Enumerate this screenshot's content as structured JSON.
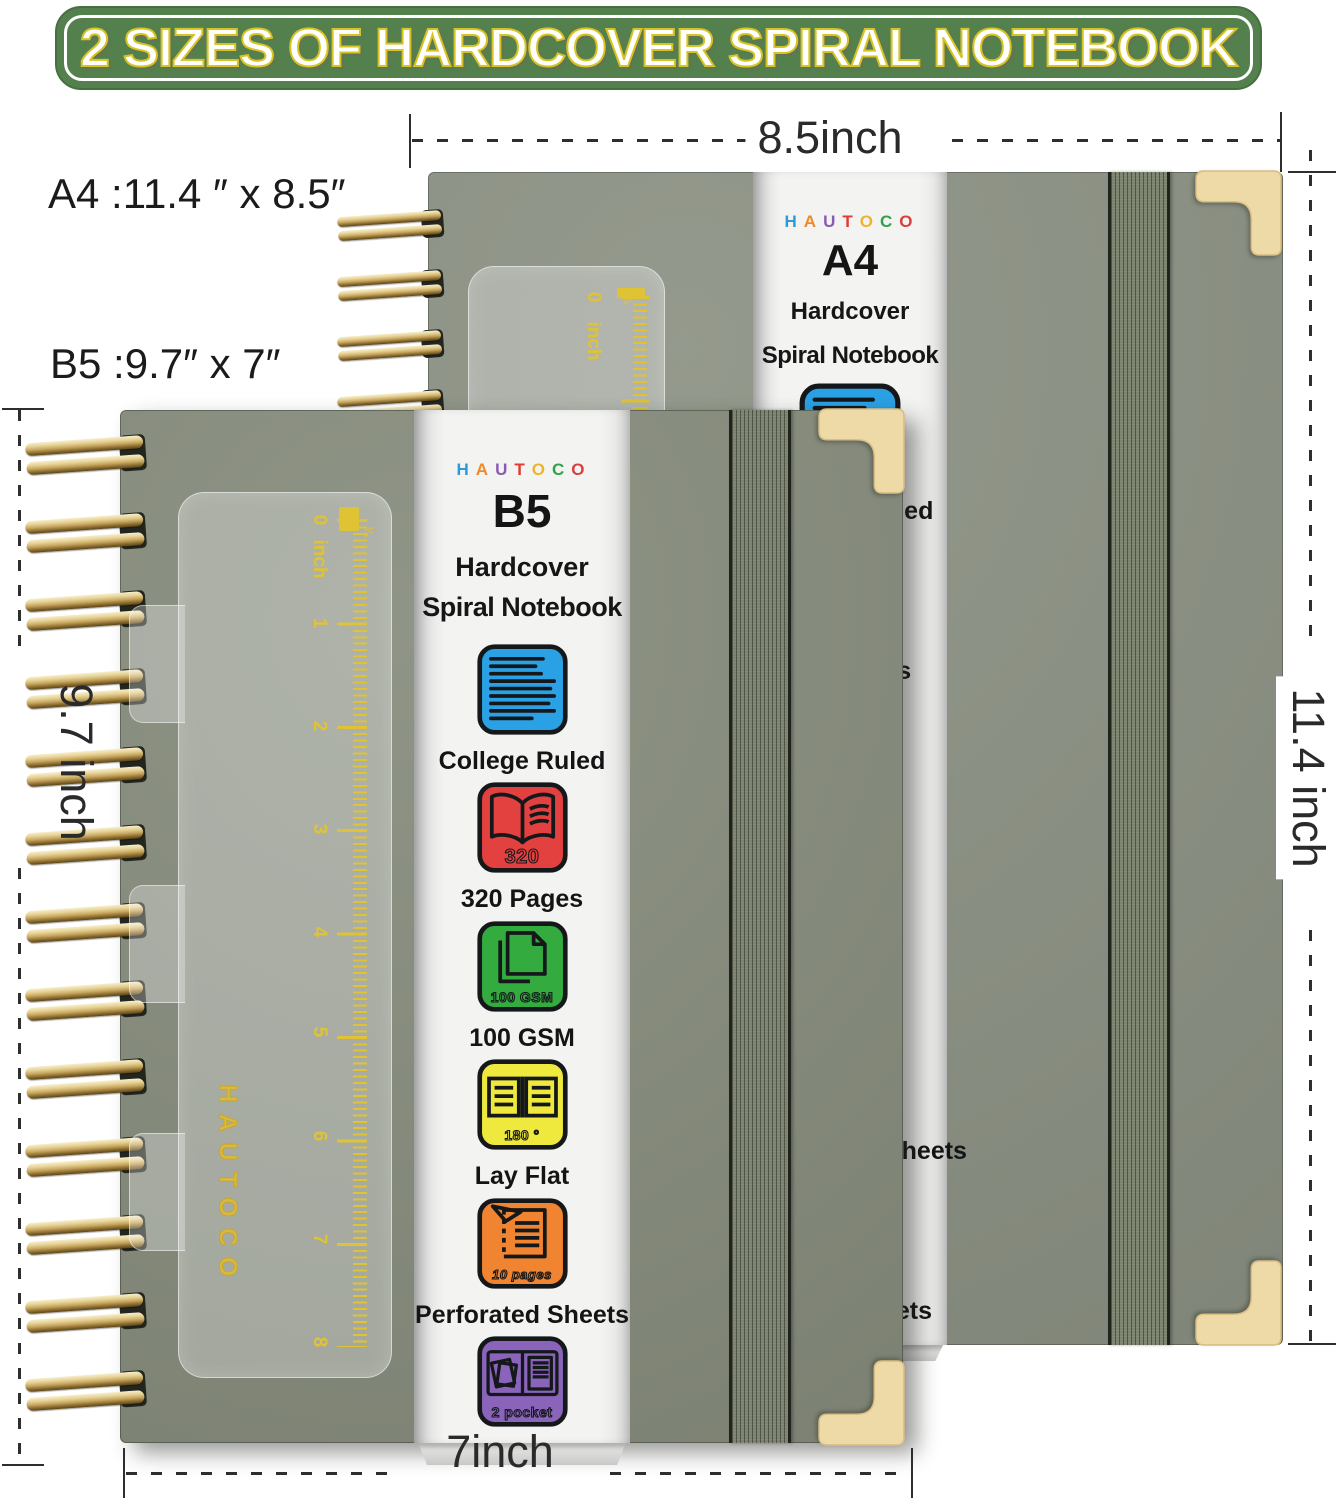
{
  "title": "2 SIZES OF HARDCOVER SPIRAL NOTEBOOK",
  "size_labels": {
    "a4": "A4 :11.4 ″ x 8.5″",
    "b5": "B5 :9.7″ x 7″"
  },
  "dimensions": {
    "top": "8.5inch",
    "right": "11.4 inch",
    "bottom": "7inch",
    "left": "9.7 inch"
  },
  "brand": {
    "name": "HAUTOCO",
    "letters": [
      {
        "ch": "H",
        "color": "#2d9bd6"
      },
      {
        "ch": "A",
        "color": "#f08a28"
      },
      {
        "ch": "U",
        "color": "#8a5ab4"
      },
      {
        "ch": "T",
        "color": "#e23a32"
      },
      {
        "ch": "O",
        "color": "#f0b42c"
      },
      {
        "ch": "C",
        "color": "#2fa24a"
      },
      {
        "ch": "O",
        "color": "#d84040"
      }
    ]
  },
  "notebooks": {
    "a4": {
      "model": "A4",
      "type_line1": "Hardcover",
      "type_line2": "Spiral Notebook"
    },
    "b5": {
      "model": "B5",
      "type_line1": "Hardcover",
      "type_line2": "Spiral Notebook"
    }
  },
  "features": [
    {
      "id": "college-ruled",
      "label": "College Ruled",
      "color": "#2aa1e4",
      "badge": ""
    },
    {
      "id": "320-pages",
      "label": "320 Pages",
      "color": "#e34040",
      "badge": "320"
    },
    {
      "id": "100-gsm",
      "label": "100 GSM",
      "color": "#33ab3f",
      "badge": "100 GSM"
    },
    {
      "id": "lay-flat",
      "label": "Lay Flat",
      "color": "#efe93e",
      "badge": "180 °"
    },
    {
      "id": "perforated-sheets",
      "label": "Perforated  Sheets",
      "color": "#f08430",
      "badge": "10 pages"
    },
    {
      "id": "inner-pockets",
      "label": "Inner Pockets",
      "color": "#8a64ba",
      "badge": "2 pocket"
    }
  ],
  "ruler": {
    "unit": "inch",
    "zero": "0",
    "eighth": "⅛",
    "b5_numbers": [
      "1",
      "2",
      "3",
      "4",
      "5",
      "6",
      "7",
      "8"
    ]
  },
  "cover_logo": "HAUTOCO",
  "colors": {
    "banner_green": "#54804e",
    "banner_outline": "#d8c326",
    "cover_a4": "#8b9183",
    "cover_b5": "#878d7d",
    "gold_spiral": "#c9a95c",
    "corner_protector": "#eedaa6",
    "ruler_marks": "#dfc334",
    "strip_bg": "#f1f1f0",
    "band": "#7b836f"
  }
}
